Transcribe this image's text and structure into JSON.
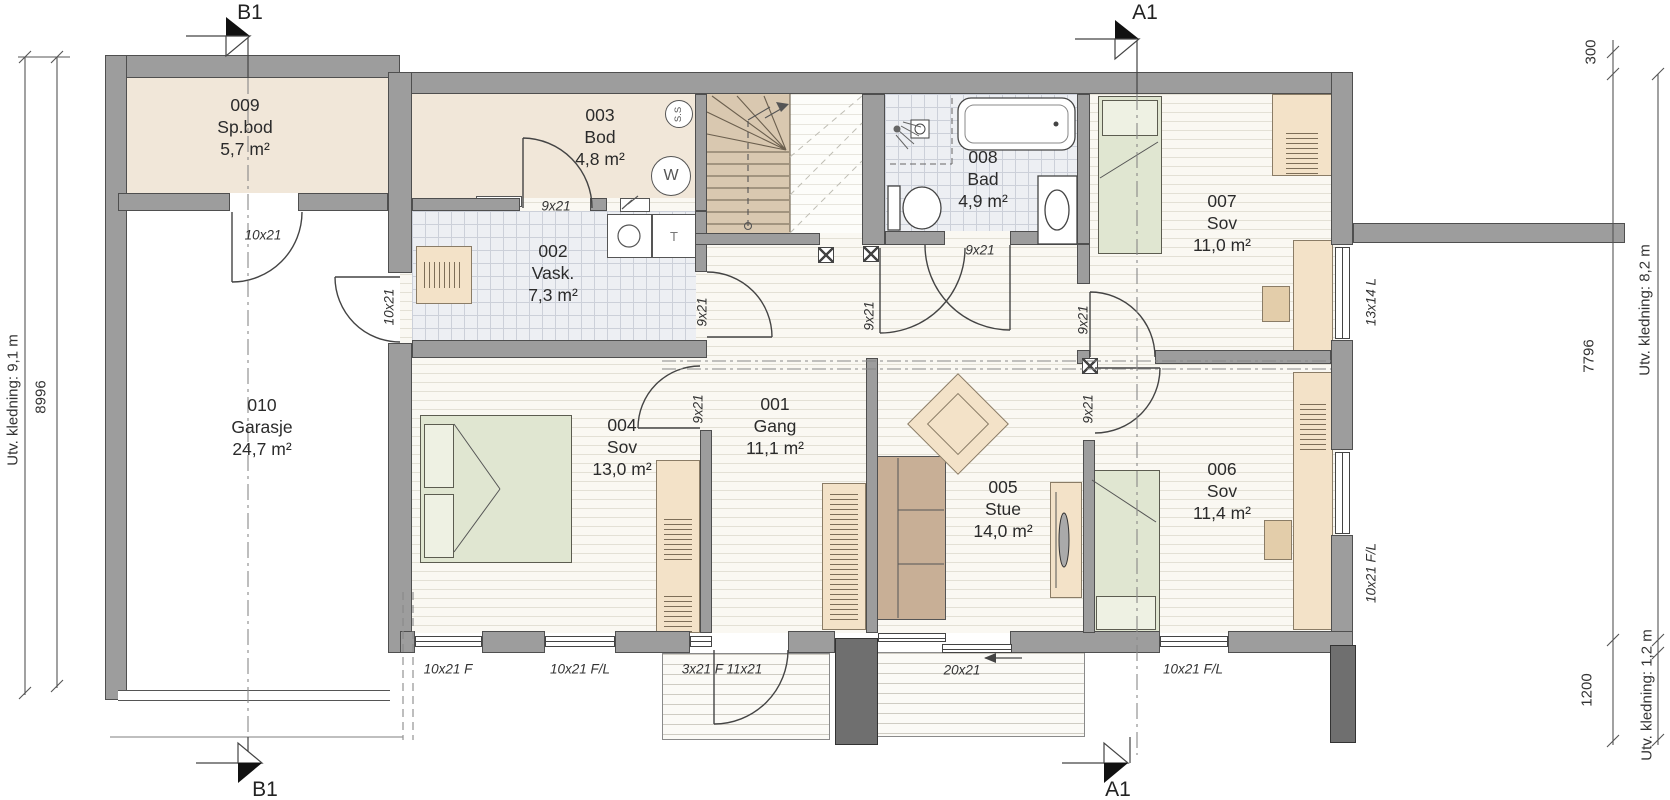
{
  "plan": {
    "rooms": [
      {
        "num": "001",
        "name": "Gang",
        "area": "11,1 m²"
      },
      {
        "num": "002",
        "name": "Vask.",
        "area": "7,3 m²"
      },
      {
        "num": "003",
        "name": "Bod",
        "area": "4,8 m²"
      },
      {
        "num": "004",
        "name": "Sov",
        "area": "13,0 m²"
      },
      {
        "num": "005",
        "name": "Stue",
        "area": "14,0 m²"
      },
      {
        "num": "006",
        "name": "Sov",
        "area": "11,4 m²"
      },
      {
        "num": "007",
        "name": "Sov",
        "area": "11,0 m²"
      },
      {
        "num": "008",
        "name": "Bad",
        "area": "4,9 m²"
      },
      {
        "num": "009",
        "name": "Sp.bod",
        "area": "5,7 m²"
      },
      {
        "num": "010",
        "name": "Garasje",
        "area": "24,7 m²"
      }
    ],
    "openings": {
      "spbod_door": "10x21",
      "garage_side_door": "10x21",
      "bod_door": "9x21",
      "vask_door": "9x21",
      "sov004_door": "9x21",
      "hall_door": "9x21",
      "bad_door": "9x21",
      "sov007_door": "9x21",
      "sov006_door": "9x21",
      "window_13x14": "13x14 L",
      "window_f": "10x21 F",
      "window_fl_1": "10x21 F/L",
      "entry_door": "3x21 F 11x21",
      "sliding_door": "20x21",
      "window_fl_2": "10x21 F/L",
      "window_fl_right": "10x21 F/L"
    },
    "dimensions": {
      "left_outer": "Utv. kledning: 9,1 m",
      "left_inner": "8996",
      "right_top": "300",
      "right_mid": "7796",
      "right_bottom": "1200",
      "right_outer_mid": "Utv. kledning: 8,2 m",
      "right_outer_bottom": "Utv. kledning: 1,2 m"
    },
    "markers": {
      "section_a": "A1",
      "section_b": "B1"
    },
    "symbols": {
      "ss": "S.S",
      "hot_water": "W",
      "dryer": "T"
    },
    "colors": {
      "wall": "#9d9d9d",
      "wall_edge": "#4f4f4f",
      "beige_floor": "#f1e7d9",
      "tile_floor": "#edeff3",
      "wood_floor": "#faf8f2",
      "deck": "#fbfaf6",
      "furniture_green": "#e0e6d1",
      "furniture_tan": "#f3e2c8",
      "sofa": "#c8af96",
      "stairs": "#d9c8b0"
    }
  }
}
